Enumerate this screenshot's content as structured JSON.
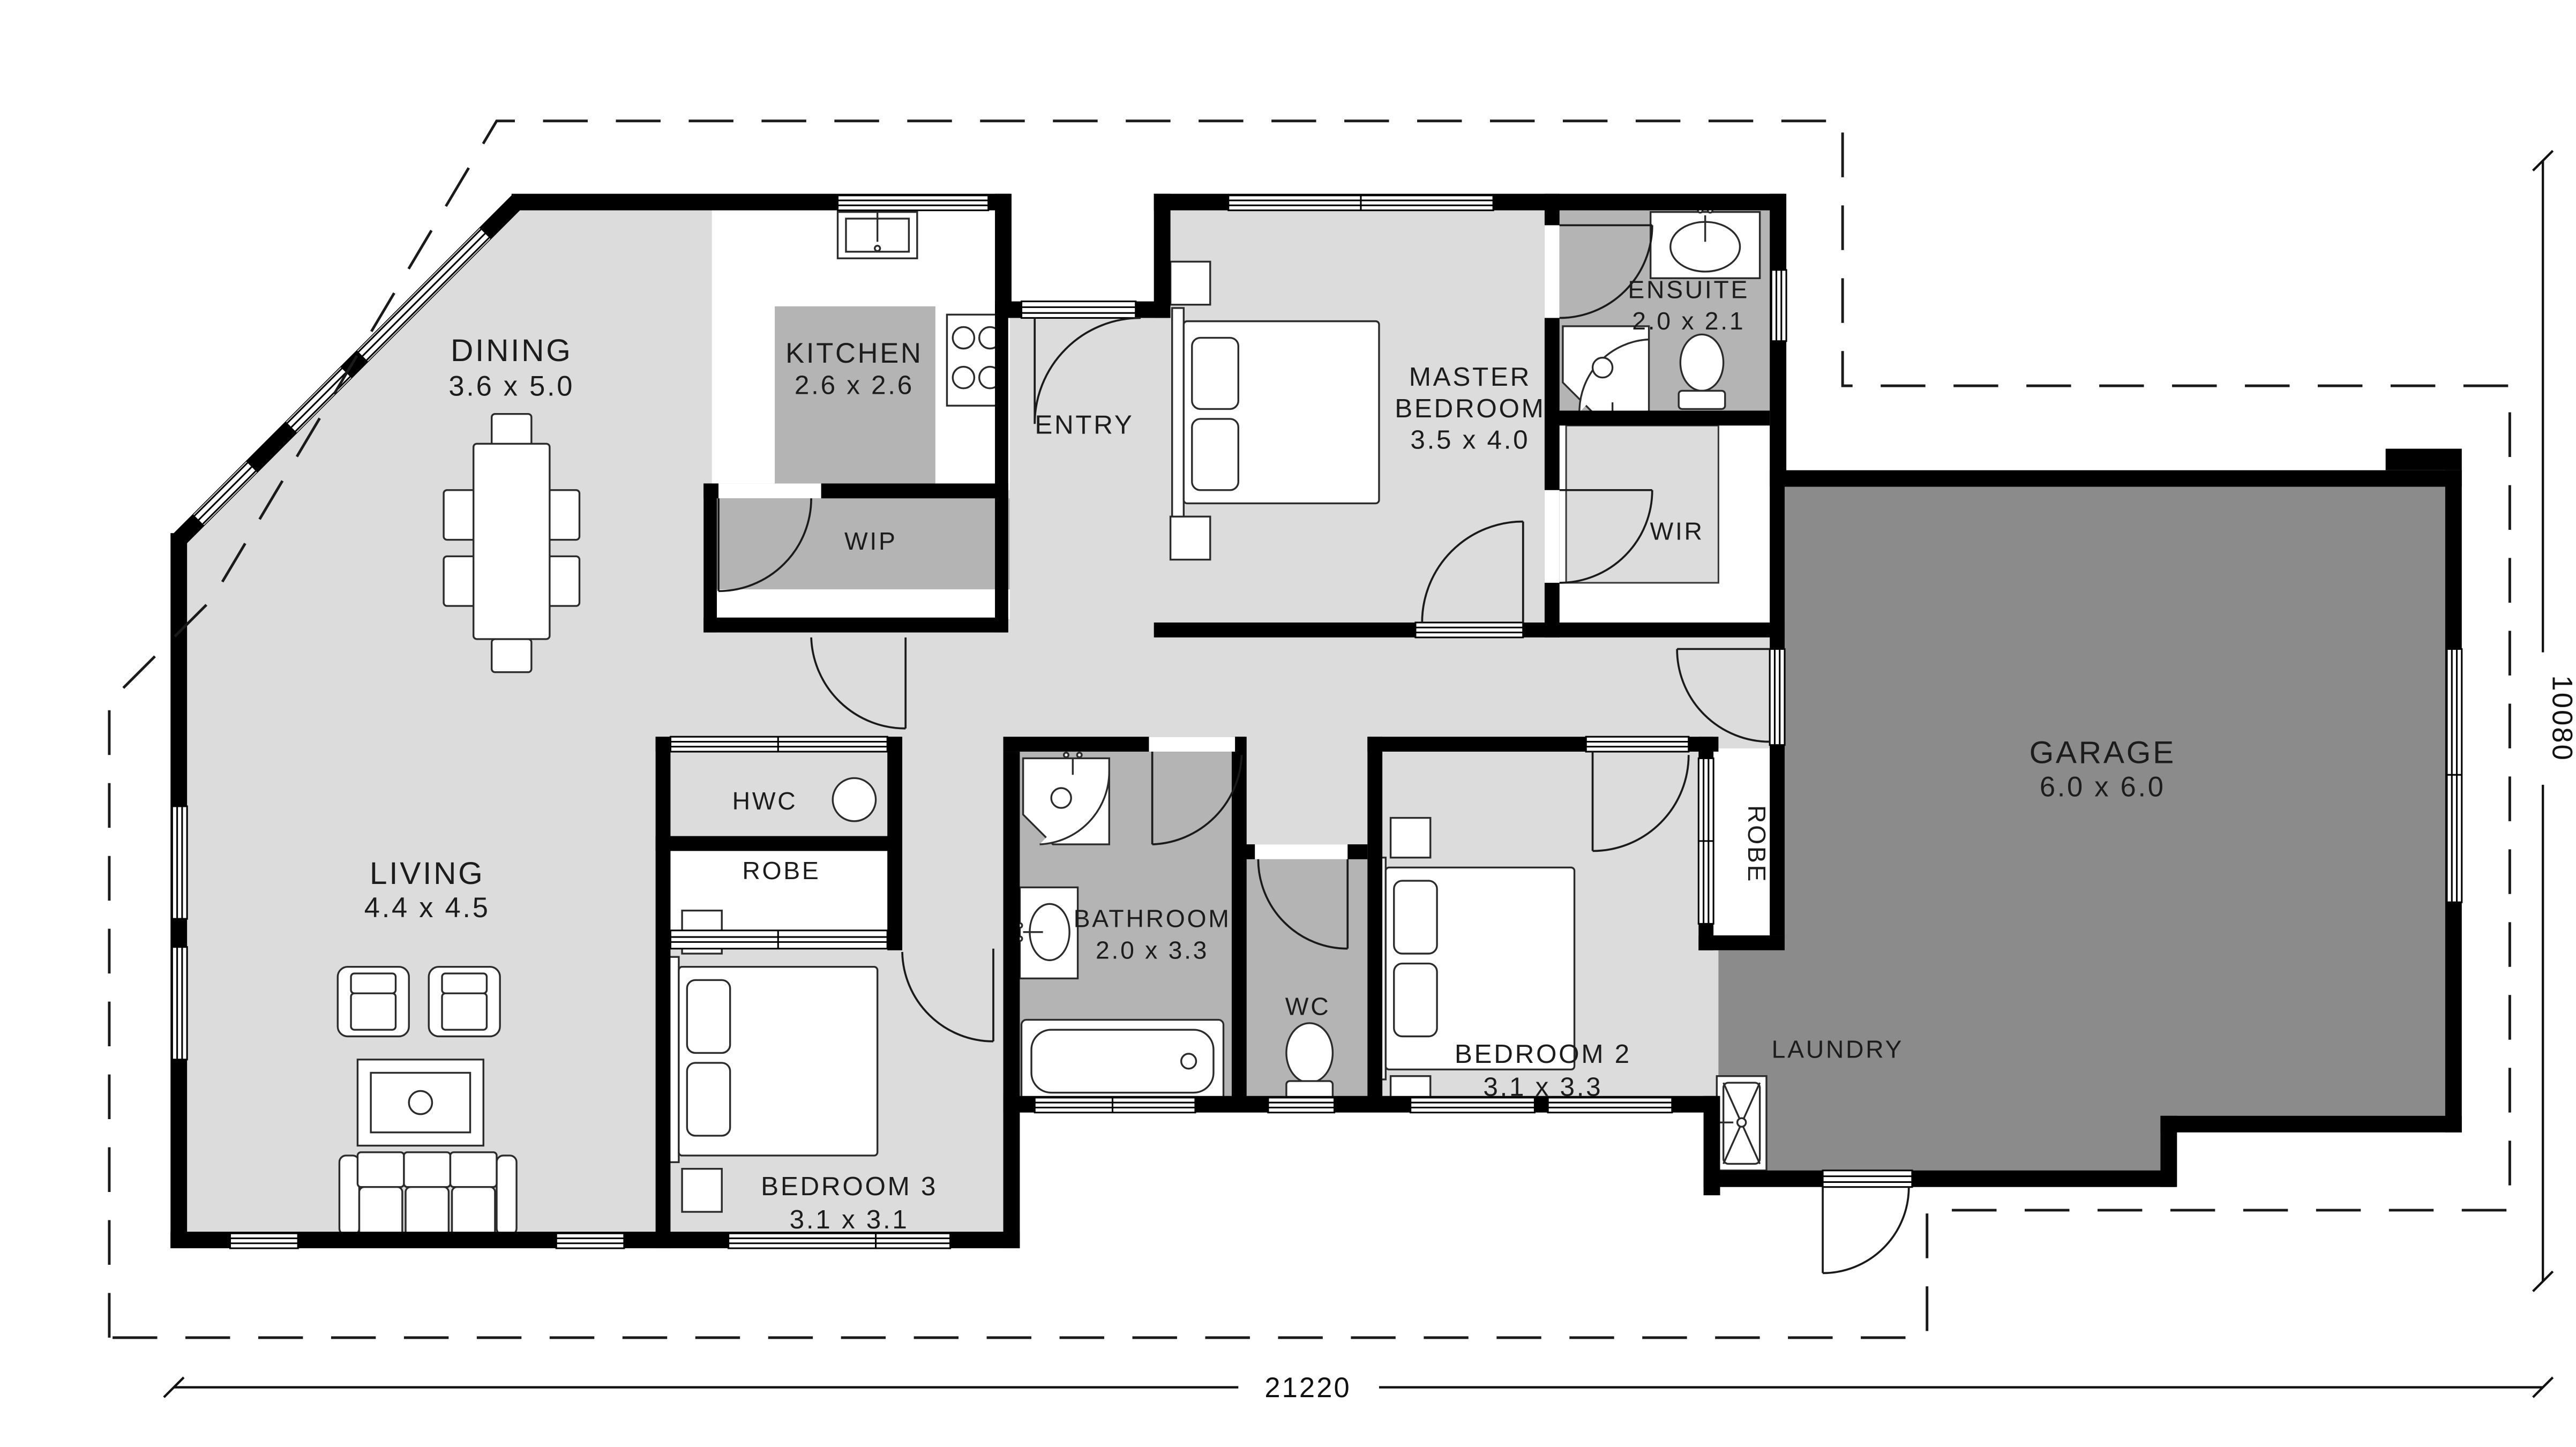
{
  "floor_plan": {
    "title": "Single storey house floor plan",
    "rooms": {
      "dining": {
        "name": "DINING",
        "dims": "3.6 x 5.0"
      },
      "kitchen": {
        "name": "KITCHEN",
        "dims": "2.6 x 2.6"
      },
      "entry": {
        "name": "ENTRY"
      },
      "master_bedroom": {
        "name_line1": "MASTER",
        "name_line2": "BEDROOM",
        "dims": "3.5 x 4.0"
      },
      "ensuite": {
        "name": "ENSUITE",
        "dims": "2.0 x 2.1"
      },
      "wir": {
        "name": "WIR"
      },
      "wip": {
        "name": "WIP"
      },
      "garage": {
        "name": "GARAGE",
        "dims": "6.0 x 6.0"
      },
      "hwc": {
        "name": "HWC"
      },
      "robe_hall": {
        "name": "ROBE"
      },
      "living": {
        "name": "LIVING",
        "dims": "4.4 x 4.5"
      },
      "bathroom": {
        "name": "BATHROOM",
        "dims": "2.0 x 3.3"
      },
      "wc": {
        "name": "WC"
      },
      "bedroom2": {
        "name": "BEDROOM 2",
        "dims": "3.1 x 3.3"
      },
      "robe_bedroom2": {
        "name": "ROBE"
      },
      "laundry": {
        "name": "LAUNDRY"
      },
      "bedroom3": {
        "name": "BEDROOM 3",
        "dims": "3.1 x 3.1"
      }
    },
    "dimensions": {
      "overall_width": "21220",
      "overall_height": "10080"
    },
    "colors": {
      "wall": "#000000",
      "floor_light": "#dcdcdc",
      "floor_mid": "#b4b4b4",
      "floor_dark": "#8b8b8b",
      "floor_white": "#ffffff"
    }
  }
}
